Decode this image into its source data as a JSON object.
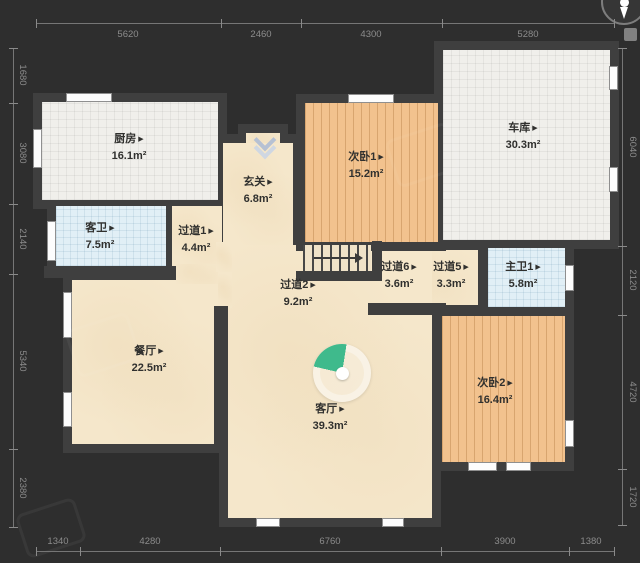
{
  "plan": {
    "type": "residential-floor-plan",
    "glyphs": {
      "room_arrow": "▶"
    },
    "colors": {
      "background": "#2e2e2e",
      "wall": "#3f3f3f",
      "floor_beige": "#f5e7cb",
      "floor_wood": "#f2c28e",
      "floor_tile_white": "#f0efeb",
      "floor_tile_blue": "#e1eff6",
      "panorama_green": "#3fba8c",
      "dimension_text": "#8c8c8c",
      "room_text": "#30302e"
    },
    "rooms": [
      {
        "id": "kitchen",
        "name": "厨房",
        "area": "16.1m²",
        "floor": "tile-white"
      },
      {
        "id": "guest-bath",
        "name": "客卫",
        "area": "7.5m²",
        "floor": "tile-blue"
      },
      {
        "id": "hallway-1",
        "name": "过道1",
        "area": "4.4m²",
        "floor": "beige"
      },
      {
        "id": "foyer",
        "name": "玄关",
        "area": "6.8m²",
        "floor": "beige"
      },
      {
        "id": "bedroom-1",
        "name": "次卧1",
        "area": "15.2m²",
        "floor": "wood"
      },
      {
        "id": "garage",
        "name": "车库",
        "area": "30.3m²",
        "floor": "tile-white"
      },
      {
        "id": "hallway-2",
        "name": "过道2",
        "area": "9.2m²",
        "floor": "beige"
      },
      {
        "id": "hallway-6",
        "name": "过道6",
        "area": "3.6m²",
        "floor": "beige"
      },
      {
        "id": "hallway-5",
        "name": "过道5",
        "area": "3.3m²",
        "floor": "beige"
      },
      {
        "id": "master-bath",
        "name": "主卫1",
        "area": "5.8m²",
        "floor": "tile-blue"
      },
      {
        "id": "dining",
        "name": "餐厅",
        "area": "22.5m²",
        "floor": "beige"
      },
      {
        "id": "living",
        "name": "客厅",
        "area": "39.3m²",
        "floor": "beige"
      },
      {
        "id": "bedroom-2",
        "name": "次卧2",
        "area": "16.4m²",
        "floor": "wood"
      }
    ],
    "dimensions_mm": {
      "top": [
        "5620",
        "2460",
        "4300",
        "5280"
      ],
      "bottom": [
        "1340",
        "4280",
        "6760",
        "3900",
        "1380"
      ],
      "left": [
        "1680",
        "3080",
        "2140",
        "5340",
        "2380"
      ],
      "right": [
        "6040",
        "2120",
        "4720",
        "1720"
      ]
    }
  }
}
